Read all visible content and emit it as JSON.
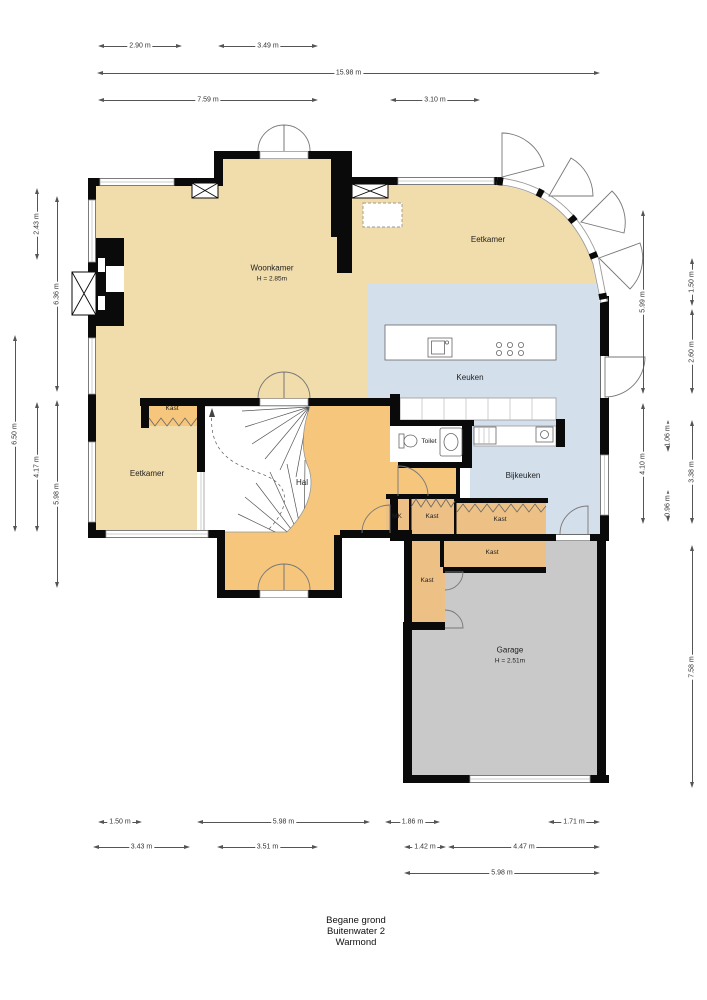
{
  "rooms": {
    "woonkamer": {
      "label": "Woonkamer",
      "height": "H = 2.85m"
    },
    "eetkamer_top": {
      "label": "Eetkamer"
    },
    "keuken": {
      "label": "Keuken"
    },
    "eetkamer_left": {
      "label": "Eetkamer"
    },
    "hal": {
      "label": "Hal"
    },
    "kast_top": {
      "label": "Kast"
    },
    "toilet": {
      "label": "Toilet"
    },
    "bijkeuken": {
      "label": "Bijkeuken"
    },
    "mk": {
      "label": "MK"
    },
    "kast_1": {
      "label": "Kast"
    },
    "kast_2": {
      "label": "Kast"
    },
    "kast_3": {
      "label": "Kast"
    },
    "kast_4": {
      "label": "Kast"
    },
    "garage": {
      "label": "Garage",
      "height": "H = 2.51m"
    }
  },
  "dimensions": {
    "top": [
      "2.90 m",
      "3.49 m",
      "15.98 m",
      "7.59 m",
      "3.10 m"
    ],
    "left": [
      "2.43 m",
      "6.36 m",
      "6.50 m",
      "4.17 m",
      "5.98 m"
    ],
    "right": [
      "5.99 m",
      "4.10 m",
      "1.06 m",
      "0.96 m",
      "1.50 m",
      "2.60 m",
      "3.38 m",
      "7.58 m"
    ],
    "bottom": [
      "1.50 m",
      "5.98 m",
      "1.86 m",
      "1.71 m",
      "3.43 m",
      "3.51 m",
      "1.42 m",
      "4.47 m",
      "5.98 m"
    ]
  },
  "footer": {
    "line1": "Begane grond",
    "line2": "Buitenwater 2",
    "line3": "Warmond"
  },
  "colors": {
    "wall": "#0a0a0a",
    "living": "#f1dcab",
    "hall": "#f5c67c",
    "closet": "#edc086",
    "kitchen": "#d3dfeb",
    "garage": "#c9c9c9"
  }
}
